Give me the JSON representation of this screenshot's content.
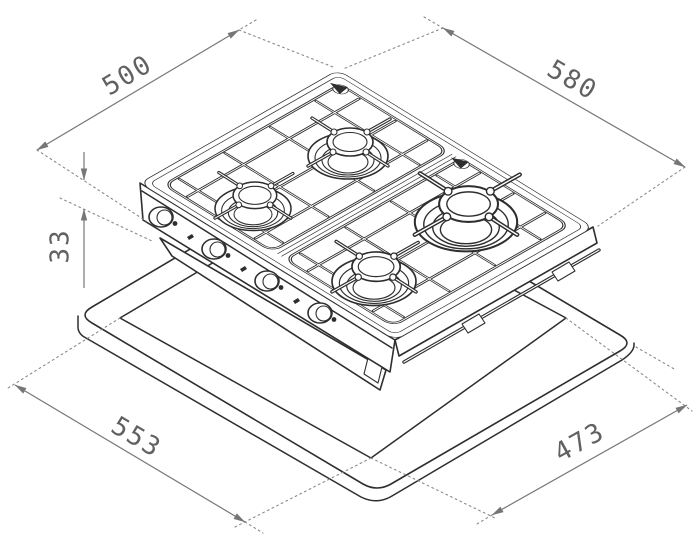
{
  "diagram": {
    "type": "gas-hob-installation-dimensions",
    "background": "#ffffff",
    "line_color": "#2e2e2e",
    "dimension_color": "#767676",
    "hob": {
      "burner_count": 4,
      "knob_count": 4
    },
    "dimensions": {
      "top_left_edge": {
        "label": "500"
      },
      "top_right_edge": {
        "label": "580"
      },
      "height": {
        "label": "33"
      },
      "cutout_front_left": {
        "label": "553"
      },
      "cutout_front_right": {
        "label": "473"
      }
    }
  }
}
